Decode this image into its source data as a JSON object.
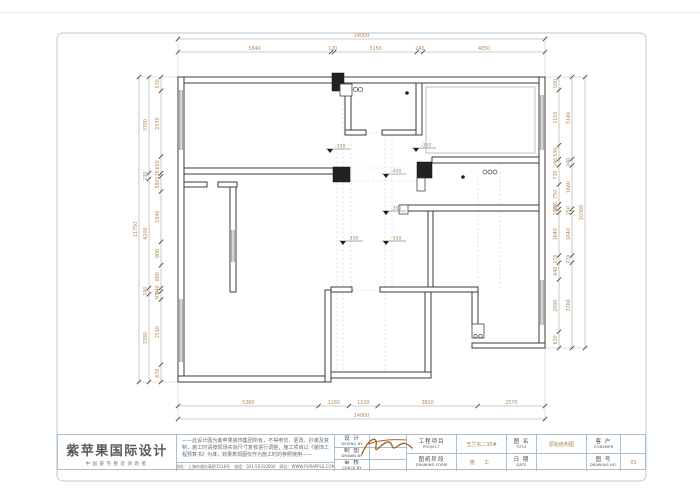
{
  "plan": {
    "dims": {
      "top_total": [
        14000
      ],
      "top_inner": [
        5840,
        120,
        3150,
        240,
        4650
      ],
      "bottom_inner": [
        5360,
        1160,
        1100,
        3810,
        2570
      ],
      "bottom_total": [
        14000
      ],
      "left_outer": [
        11750
      ],
      "left_middle": [
        3700,
        230,
        4200,
        240,
        3380
      ],
      "left_inner": [
        530,
        2530,
        650,
        120,
        580,
        1940,
        900,
        880,
        140,
        300,
        2510,
        670
      ],
      "right_inner": [
        500,
        2110,
        530,
        240,
        730,
        750,
        180,
        150,
        1640,
        270,
        640,
        2000,
        620
      ],
      "right_middle": [
        3140,
        240,
        1660,
        150,
        1640,
        270,
        3260
      ],
      "right_outer": [
        10360
      ]
    },
    "levels": [
      {
        "label": "-350"
      },
      {
        "label": "-350"
      },
      {
        "label": "-400"
      },
      {
        "label": "-350"
      },
      {
        "label": "-350"
      },
      {
        "label": "-350"
      }
    ]
  },
  "titleblock": {
    "company": "紫苹果国际设计",
    "tagline": "中国豪宅整装领跑者",
    "disclaimer": "——此设计图为紫苹果装饰集团所有，不得参仿、更改、抄袭及复制，施工时请按现场实际尺寸复核进行调整，施工项目以《装饰工程预算书》为准，效果表现图仅作为施工时的参照使用——",
    "address": "地址：上海市浦东高桥1518号　电话：021-50310000　网址：WWW.PURAPPLE.COM",
    "fields": {
      "design_cn": "设  计",
      "design_en": "DESING  BY",
      "draw_cn": "制  图",
      "draw_en": "DRAWN  BY",
      "check_cn": "审  核",
      "check_en": "CHECK  BY",
      "project_cn": "工程项目",
      "project_en": "PROJECT",
      "stage_cn": "图纸阶段",
      "stage_en": "DRAWING FORM",
      "title_cn": "图  名",
      "title_en": "TITLE",
      "date_cn": "日  期",
      "date_en": "DATE",
      "customer_cn": "客  户",
      "customer_en": "CONSMER",
      "no_cn": "图  号",
      "no_en": "DRAWING NO."
    },
    "values": {
      "project": "玉兰东二30#",
      "stage": "施  工",
      "title": "原始结构图",
      "number": "01"
    },
    "colors": {
      "accent": "#ad7f42",
      "border": "#a9bfd2",
      "wall": "#3b3b3b"
    }
  }
}
